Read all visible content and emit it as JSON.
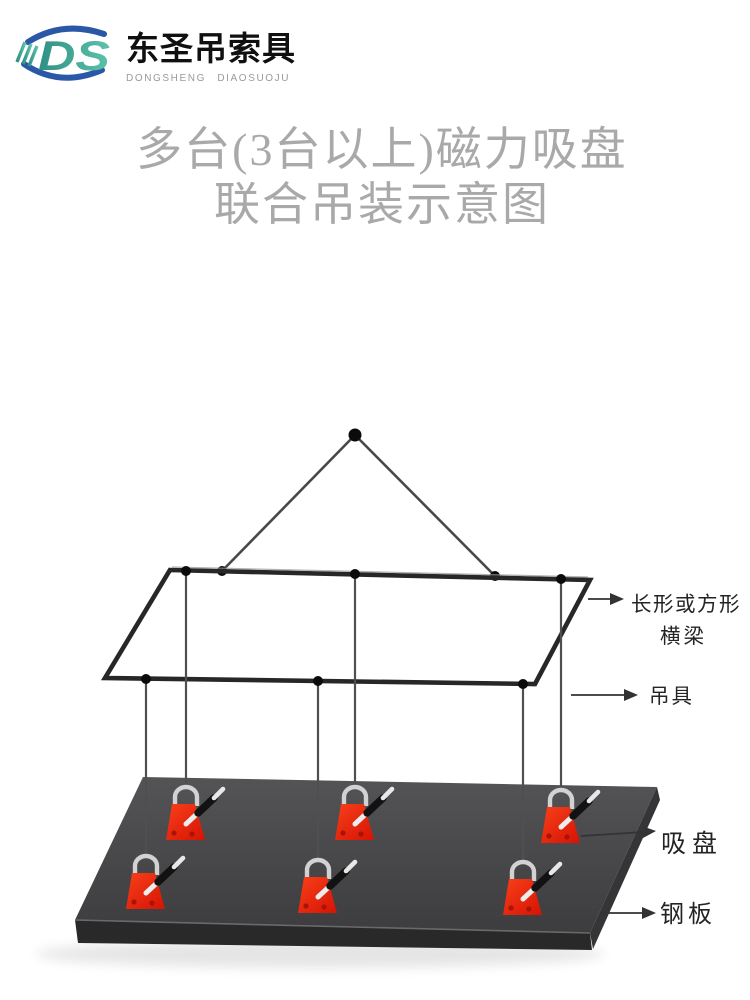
{
  "brand": {
    "monogram": "DS",
    "name_cn": "东圣吊索具",
    "name_en": "DONGSHENG DIAOSUOJU"
  },
  "title": {
    "line1": "多台(3台以上)磁力吸盘",
    "line2": "联合吊装示意图"
  },
  "colors": {
    "brand_blue": "#2b57a7",
    "brand_teal_dark": "#2f8f86",
    "brand_teal_light": "#5cc3a8",
    "brand_en_gray": "#9a9a9a",
    "title_gray": "#a9a9a9",
    "line_gray": "#4f4f4f",
    "beam_dark": "#272727",
    "dot_black": "#0b0b0b",
    "plate_top_light": "#545456",
    "plate_top_dark": "#3d3d3f",
    "plate_front": "#29292a",
    "plate_side": "#353537",
    "magnet_red_light": "#f8401a",
    "magnet_red_dark": "#d71505",
    "shackle_silver": "#d2d2d2",
    "label_ink": "#242424"
  },
  "diagram": {
    "labels": {
      "beam_label_line1": "长形或方形",
      "beam_label_line2": "横梁",
      "rigging_label": "吊具",
      "magnet_label": "吸盘",
      "plate_label": "钢板"
    },
    "magnet_count": 6,
    "apex": {
      "x": 355,
      "y": 435
    },
    "triangle_attach": [
      {
        "x": 222,
        "y": 571
      },
      {
        "x": 495,
        "y": 576
      }
    ],
    "beam_corners": "170,570 590,580 535,684 105,678",
    "plate_top_corners": "143,777 657,787 590,933 75,920",
    "drops": [
      {
        "x": 186,
        "beam_y": 571,
        "magnet_y": 783
      },
      {
        "x": 355,
        "beam_y": 574,
        "magnet_y": 783
      },
      {
        "x": 561,
        "beam_y": 579,
        "magnet_y": 786
      },
      {
        "x": 146,
        "beam_y": 679,
        "magnet_y": 852
      },
      {
        "x": 318,
        "beam_y": 681,
        "magnet_y": 856
      },
      {
        "x": 523,
        "beam_y": 684,
        "magnet_y": 858
      }
    ]
  }
}
